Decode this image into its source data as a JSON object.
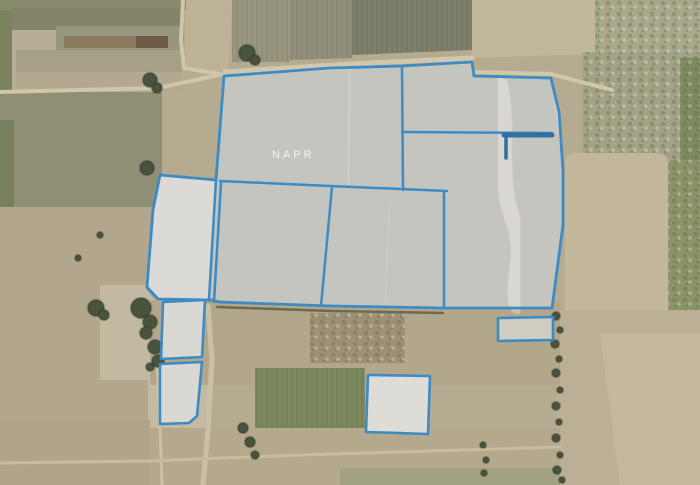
{
  "app": {
    "type": "satellite-cadastral-map",
    "watermark": {
      "text": "NAPR",
      "x": 272,
      "y": 158
    }
  },
  "colors": {
    "base": "#b5ab91",
    "parcel_stroke": "#3d8bc4",
    "parcel_stroke_dark": "#2f6fa3",
    "parcel_fill": "rgba(233,238,244,0.52)",
    "tree_fill": "#49523d",
    "tree_edge": "#333b2b"
  },
  "map": {
    "width": 700,
    "height": 485,
    "fields": [
      {
        "name": "field-topleft-olive-strip",
        "rect": [
          0,
          0,
          188,
          10
        ],
        "fill": "#8a8a6d"
      },
      {
        "name": "field-left-green-strip",
        "rect": [
          0,
          10,
          12,
          115
        ],
        "fill": "#7a8260"
      },
      {
        "name": "field-topleft-olive",
        "rect": [
          12,
          8,
          172,
          24
        ],
        "fill": "#84846b"
      },
      {
        "name": "field-topleft-tan",
        "rect": [
          12,
          30,
          44,
          60
        ],
        "fill": "#b6ad94"
      },
      {
        "name": "field-topleft-gray",
        "rect": [
          56,
          26,
          128,
          24
        ],
        "fill": "#97977f"
      },
      {
        "name": "field-topleft-brown",
        "rect": [
          64,
          36,
          72,
          12
        ],
        "fill": "#8a7a5e"
      },
      {
        "name": "field-topleft-darkbrown",
        "rect": [
          136,
          36,
          32,
          12
        ],
        "fill": "#6e5c46"
      },
      {
        "name": "field-topleft-olivetan",
        "rect": [
          16,
          50,
          166,
          22
        ],
        "fill": "#a5a186"
      },
      {
        "name": "field-topleft-lowertan",
        "rect": [
          16,
          72,
          166,
          18
        ],
        "fill": "#b2a98f"
      },
      {
        "name": "field-topleft-roadside",
        "poly": [
          [
            186,
            0
          ],
          [
            232,
            0
          ],
          [
            228,
            72
          ],
          [
            186,
            70
          ]
        ],
        "fill": "#bdb399"
      },
      {
        "name": "field-midleft-olive",
        "rect": [
          0,
          92,
          162,
          115
        ],
        "fill": "#8f8f76"
      },
      {
        "name": "field-left-greenedge",
        "rect": [
          0,
          120,
          14,
          87
        ],
        "fill": "#76805e"
      },
      {
        "name": "field-left-tan",
        "rect": [
          0,
          207,
          160,
          278
        ],
        "fill": "#b2a78c"
      },
      {
        "name": "field-trees-bright",
        "rect": [
          100,
          285,
          65,
          95
        ],
        "fill": "#c2b9a0"
      },
      {
        "name": "field-left-bright-low",
        "rect": [
          148,
          378,
          62,
          107
        ],
        "fill": "#c4baa1"
      },
      {
        "name": "field-topmid-stripes-a",
        "poly": [
          [
            232,
            0
          ],
          [
            352,
            0
          ],
          [
            352,
            58
          ],
          [
            232,
            62
          ]
        ],
        "fill": "#92907a",
        "pattern": "rows"
      },
      {
        "name": "field-topmid-stripes-b",
        "rect": [
          232,
          0,
          58,
          62
        ],
        "fill": "#9a977f",
        "pattern": "rows"
      },
      {
        "name": "field-topmid-dark",
        "poly": [
          [
            352,
            0
          ],
          [
            472,
            0
          ],
          [
            472,
            50
          ],
          [
            352,
            55
          ]
        ],
        "fill": "#7e8069",
        "pattern": "rows"
      },
      {
        "name": "field-topright-tan",
        "poly": [
          [
            472,
            0
          ],
          [
            700,
            0
          ],
          [
            700,
            52
          ],
          [
            560,
            55
          ],
          [
            472,
            58
          ]
        ],
        "fill": "#c1b79d"
      },
      {
        "name": "field-topright-mottle",
        "rect": [
          595,
          0,
          105,
          52
        ],
        "fill": "#a9a78c",
        "pattern": "mottle"
      },
      {
        "name": "field-right-shrubland",
        "rect": [
          583,
          52,
          117,
          110
        ],
        "fill": "#a3a287",
        "pattern": "mottle"
      },
      {
        "name": "field-rightedge-green",
        "rect": [
          680,
          58,
          20,
          182
        ],
        "fill": "#7e8a60",
        "pattern": "mottle"
      },
      {
        "name": "field-right-smooth",
        "rrect": [
          565,
          153,
          103,
          180,
          10
        ],
        "fill": "#c3b89c"
      },
      {
        "name": "field-rightedge-green-low",
        "rect": [
          668,
          160,
          32,
          173
        ],
        "fill": "#8a9468",
        "pattern": "mottle"
      },
      {
        "name": "field-rightbottom",
        "rect": [
          556,
          310,
          144,
          175
        ],
        "fill": "#bbb095"
      },
      {
        "name": "field-rightbottom-bright",
        "poly": [
          [
            600,
            333
          ],
          [
            700,
            333
          ],
          [
            700,
            485
          ],
          [
            620,
            485
          ]
        ],
        "fill": "#c4b99c"
      },
      {
        "name": "field-midbottom-band",
        "rect": [
          150,
          300,
          410,
          85
        ],
        "fill": "#b2a78b"
      },
      {
        "name": "field-midbottom-brown",
        "rect": [
          310,
          313,
          95,
          50
        ],
        "fill": "#9e9076",
        "pattern": "mottle"
      },
      {
        "name": "field-bottom-green-crop",
        "rect": [
          255,
          368,
          110,
          64
        ],
        "fill": "#7c8a5e",
        "pattern": "rows"
      },
      {
        "name": "field-bottom-tan",
        "rect": [
          150,
          428,
          410,
          57
        ],
        "fill": "#b4a98d"
      },
      {
        "name": "field-bottom-greenish",
        "rect": [
          340,
          468,
          220,
          17
        ],
        "fill": "#a2a283"
      },
      {
        "name": "field-bottomleft",
        "rect": [
          0,
          420,
          150,
          65
        ],
        "fill": "#b0a589"
      },
      {
        "name": "ground-under-cluster",
        "poly": [
          [
            160,
            175
          ],
          [
            216,
            180
          ],
          [
            224,
            76
          ],
          [
            402,
            66
          ],
          [
            472,
            62
          ],
          [
            474,
            76
          ],
          [
            551,
            78
          ],
          [
            563,
            170
          ],
          [
            563,
            225
          ],
          [
            552,
            308
          ],
          [
            217,
            303
          ],
          [
            155,
            299
          ],
          [
            146,
            289
          ],
          [
            152,
            208
          ]
        ],
        "fill": "#9b9884"
      },
      {
        "name": "ground-bright-west-parcel",
        "poly": [
          [
            160,
            175
          ],
          [
            216,
            180
          ],
          [
            209,
            299
          ],
          [
            158,
            299
          ],
          [
            147,
            287
          ],
          [
            153,
            210
          ]
        ],
        "fill": "#cac5b6"
      }
    ],
    "streaks": [
      {
        "name": "sandy-streak",
        "path": "M500,85 C510,130 496,180 515,225 C525,258 510,288 518,306",
        "stroke": "#d2c9b4",
        "width": 16,
        "opacity": 0.8
      },
      {
        "name": "field-row-line-a",
        "path": "M350,68 L348,186",
        "stroke": "#ffffff",
        "width": 1.5,
        "opacity": 0.35
      },
      {
        "name": "field-row-line-e",
        "path": "M390,196 L385,304",
        "stroke": "#ffffff",
        "width": 1.2,
        "opacity": 0.22
      },
      {
        "name": "field-line-x23",
        "path": "M23,95 L23,205",
        "stroke": "#a0a089",
        "width": 1.5,
        "opacity": 0.9
      },
      {
        "name": "field-line-x90",
        "path": "M90,95 L90,205",
        "stroke": "#a0a089",
        "width": 1.5,
        "opacity": 0.9
      }
    ],
    "roads": [
      {
        "name": "road-west",
        "points": [
          [
            0,
            92
          ],
          [
            158,
            88
          ],
          [
            228,
            73
          ]
        ],
        "color": "#cfc6ac",
        "width": 4
      },
      {
        "name": "road-north-vertical",
        "points": [
          [
            183,
            0
          ],
          [
            181,
            40
          ],
          [
            184,
            68
          ],
          [
            220,
            74
          ]
        ],
        "color": "#cfc6ac",
        "width": 4
      },
      {
        "name": "road-cluster-top",
        "points": [
          [
            225,
            72
          ],
          [
            350,
            64
          ],
          [
            472,
            58
          ]
        ],
        "color": "#d0c7ad",
        "width": 5
      },
      {
        "name": "road-cluster-topright",
        "points": [
          [
            474,
            72
          ],
          [
            551,
            74
          ],
          [
            612,
            90
          ]
        ],
        "color": "#d0c7ad",
        "width": 4
      },
      {
        "name": "hedge-cluster-bottom",
        "points": [
          [
            217,
            307
          ],
          [
            330,
            311
          ],
          [
            443,
            313
          ]
        ],
        "color": "#6e6a52",
        "width": 2.5
      },
      {
        "name": "road-south-vertical",
        "points": [
          [
            208,
            306
          ],
          [
            212,
            360
          ],
          [
            208,
            430
          ],
          [
            203,
            485
          ]
        ],
        "color": "#c9c0a6",
        "width": 5
      },
      {
        "name": "trail-parcel-left",
        "points": [
          [
            157,
            360
          ],
          [
            160,
            425
          ],
          [
            162,
            485
          ]
        ],
        "color": "#c9c0a6",
        "width": 3
      },
      {
        "name": "road-bottom",
        "points": [
          [
            0,
            463
          ],
          [
            150,
            461
          ],
          [
            300,
            455
          ],
          [
            560,
            447
          ]
        ],
        "color": "#c6bca0",
        "width": 3
      }
    ],
    "trees": [
      {
        "x": 150,
        "y": 80,
        "r": 7
      },
      {
        "x": 157,
        "y": 88,
        "r": 5
      },
      {
        "x": 247,
        "y": 53,
        "r": 8
      },
      {
        "x": 255,
        "y": 60,
        "r": 5
      },
      {
        "x": 147,
        "y": 168,
        "r": 7
      },
      {
        "x": 78,
        "y": 258,
        "r": 3
      },
      {
        "x": 100,
        "y": 235,
        "r": 3
      },
      {
        "x": 96,
        "y": 308,
        "r": 8
      },
      {
        "x": 104,
        "y": 315,
        "r": 5
      },
      {
        "x": 141,
        "y": 308,
        "r": 10
      },
      {
        "x": 150,
        "y": 322,
        "r": 7
      },
      {
        "x": 146,
        "y": 333,
        "r": 6
      },
      {
        "x": 155,
        "y": 347,
        "r": 7
      },
      {
        "x": 158,
        "y": 361,
        "r": 6
      },
      {
        "x": 150,
        "y": 367,
        "r": 4
      },
      {
        "x": 556,
        "y": 316,
        "r": 4
      },
      {
        "x": 560,
        "y": 330,
        "r": 3
      },
      {
        "x": 555,
        "y": 344,
        "r": 4
      },
      {
        "x": 559,
        "y": 359,
        "r": 3
      },
      {
        "x": 556,
        "y": 373,
        "r": 4
      },
      {
        "x": 560,
        "y": 390,
        "r": 3
      },
      {
        "x": 556,
        "y": 406,
        "r": 4
      },
      {
        "x": 559,
        "y": 422,
        "r": 3
      },
      {
        "x": 556,
        "y": 438,
        "r": 4
      },
      {
        "x": 560,
        "y": 455,
        "r": 3
      },
      {
        "x": 557,
        "y": 470,
        "r": 4
      },
      {
        "x": 562,
        "y": 480,
        "r": 3
      },
      {
        "x": 483,
        "y": 445,
        "r": 3
      },
      {
        "x": 486,
        "y": 460,
        "r": 3
      },
      {
        "x": 484,
        "y": 473,
        "r": 3
      },
      {
        "x": 243,
        "y": 428,
        "r": 5
      },
      {
        "x": 250,
        "y": 442,
        "r": 5
      },
      {
        "x": 255,
        "y": 455,
        "r": 4
      }
    ],
    "parcels": {
      "cluster_outline": [
        [
          160,
          175
        ],
        [
          216,
          180
        ],
        [
          224,
          76
        ],
        [
          330,
          68
        ],
        [
          402,
          66
        ],
        [
          472,
          62
        ],
        [
          474,
          76
        ],
        [
          551,
          78
        ],
        [
          559,
          112
        ],
        [
          563,
          170
        ],
        [
          563,
          225
        ],
        [
          556,
          278
        ],
        [
          552,
          308
        ],
        [
          443,
          308
        ],
        [
          332,
          306
        ],
        [
          219,
          302
        ],
        [
          212,
          300
        ],
        [
          158,
          299
        ],
        [
          147,
          287
        ],
        [
          153,
          210
        ]
      ],
      "inner_lines": [
        {
          "name": "boundary-a-b",
          "points": [
            [
              402,
              66
            ],
            [
              403,
              190
            ]
          ],
          "width": 2.5
        },
        {
          "name": "boundary-b-c",
          "points": [
            [
              402,
              132
            ],
            [
              552,
              133
            ]
          ],
          "width": 2.5
        },
        {
          "name": "boundary-b-c-thick",
          "points": [
            [
              504,
              135
            ],
            [
              552,
              135
            ]
          ],
          "width": 5,
          "dark": true
        },
        {
          "name": "boundary-stub",
          "points": [
            [
              506,
              134
            ],
            [
              506,
              158
            ]
          ],
          "width": 3.5,
          "dark": true
        },
        {
          "name": "boundary-a-bottom",
          "points": [
            [
              220,
              181
            ],
            [
              330,
              186
            ],
            [
              447,
              191
            ]
          ],
          "width": 2.5
        },
        {
          "name": "boundary-c-left",
          "points": [
            [
              444,
              192
            ],
            [
              444,
              308
            ]
          ],
          "width": 2.5
        },
        {
          "name": "boundary-d-e",
          "points": [
            [
              332,
              187
            ],
            [
              321,
              306
            ]
          ],
          "width": 2.5
        },
        {
          "name": "boundary-west-right",
          "points": [
            [
              216,
              180
            ],
            [
              209,
              299
            ]
          ],
          "width": 2.5
        },
        {
          "name": "boundary-d-left",
          "points": [
            [
              221,
              183
            ],
            [
              214,
              302
            ]
          ],
          "width": 2.5
        }
      ],
      "standalone": [
        {
          "name": "parcel-small-1",
          "points": [
            [
              163,
              302
            ],
            [
              205,
              300
            ],
            [
              202,
              357
            ],
            [
              161,
              359
            ]
          ],
          "bright": "#c6c0ae"
        },
        {
          "name": "parcel-small-2",
          "points": [
            [
              160,
              364
            ],
            [
              202,
              362
            ],
            [
              197,
              416
            ],
            [
              189,
              423
            ],
            [
              160,
              424
            ]
          ],
          "bright": "#c6c0ae"
        },
        {
          "name": "parcel-small-3",
          "points": [
            [
              498,
              318
            ],
            [
              553,
              317
            ],
            [
              553,
              340
            ],
            [
              498,
              341
            ]
          ],
          "bright": null
        },
        {
          "name": "parcel-square-south",
          "points": [
            [
              368,
              375
            ],
            [
              430,
              376
            ],
            [
              428,
              434
            ],
            [
              366,
              432
            ]
          ],
          "bright": "#cfc8b6"
        }
      ]
    }
  }
}
